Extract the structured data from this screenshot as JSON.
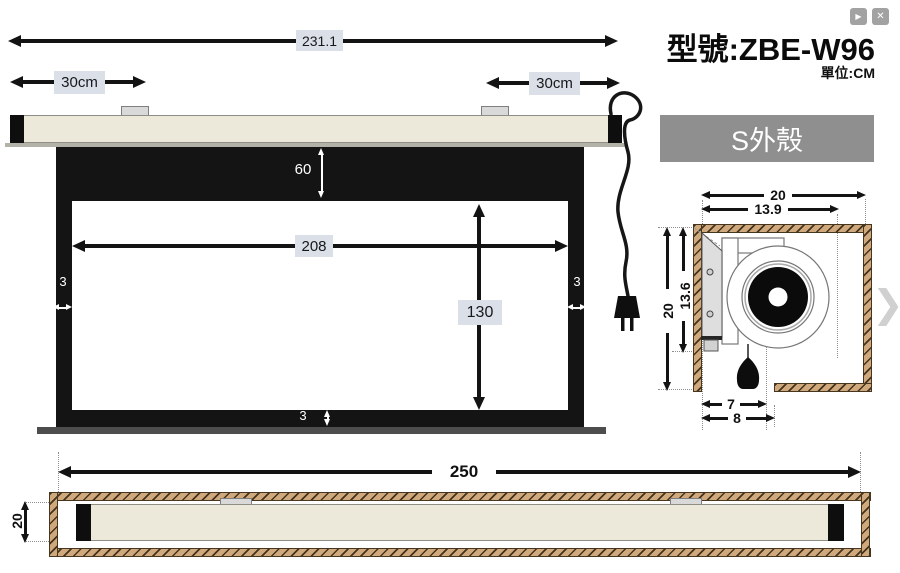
{
  "window": {
    "play_icon": "▶",
    "close_icon": "✕"
  },
  "header": {
    "title": "型號:ZBE-W96",
    "unit_label": "單位:CM"
  },
  "front_view": {
    "overall_width": "231.1",
    "left_bracket_offset": "30cm",
    "right_bracket_offset": "30cm",
    "top_drop": "60",
    "viewing_width": "208",
    "viewing_height": "130",
    "left_border": "3",
    "right_border": "3",
    "bottom_border": "3"
  },
  "section_view": {
    "title": "S外殼",
    "outer_width": "20",
    "inner_width": "13.9",
    "outer_height": "20",
    "inner_height": "13.6",
    "opening_inner": "7",
    "opening_outer": "8",
    "next_icon": "❯"
  },
  "bottom_view": {
    "overall_width": "250",
    "case_height": "20"
  },
  "colors": {
    "tag_bg": "#dbe0e8",
    "wood": "#cfa87b",
    "case_beige": "#ece9db",
    "panel_gray": "#8f8f8f"
  }
}
